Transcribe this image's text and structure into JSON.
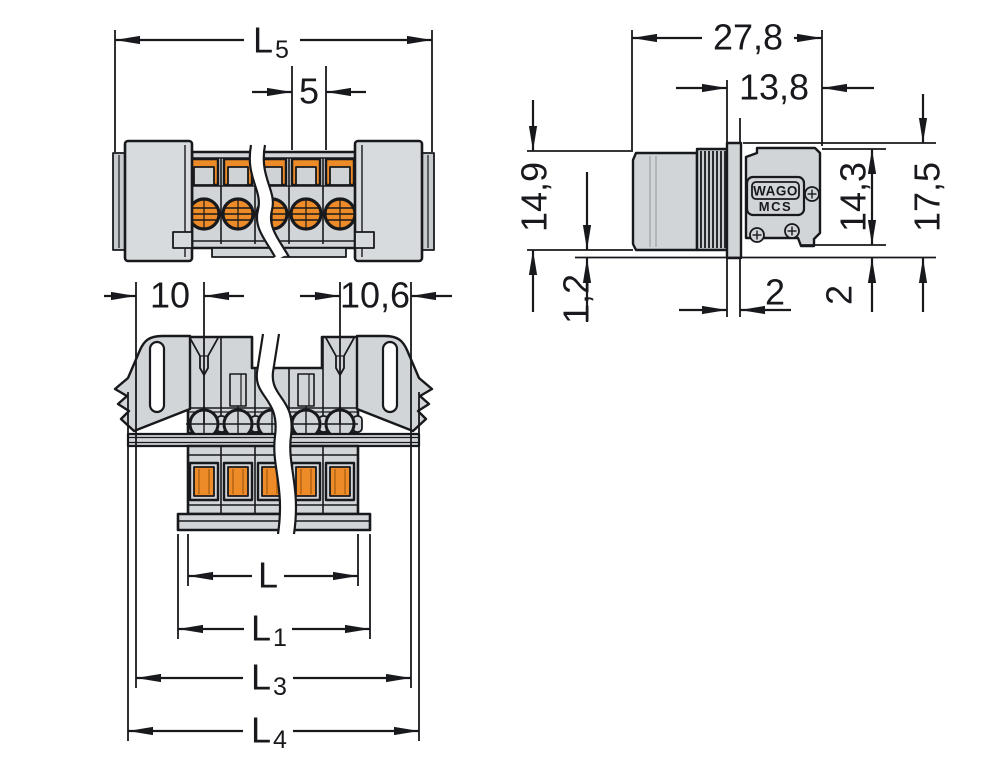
{
  "meta": {
    "description": "Dimensional line drawing of a WAGO MCS plug connector with panel mounting flanges"
  },
  "colors": {
    "line": "#17191c",
    "body": "#d2d5d7",
    "body_light": "#d8dbdd",
    "body_dark": "#c6cacc",
    "accent_orange": "#ed8b28",
    "background": "#ffffff"
  },
  "branding": {
    "logo": "WAGO",
    "series": "MCS"
  },
  "views": {
    "front": {
      "l5_base": "L",
      "l5_sub": "5",
      "pitch": "5"
    },
    "plug": {
      "d10": "10",
      "d106": "10,6",
      "l_base": "L",
      "l1_base": "L",
      "l1_sub": "1",
      "l3_base": "L",
      "l3_sub": "3",
      "l4_base": "L",
      "l4_sub": "4"
    },
    "side": {
      "d278": "27,8",
      "d138": "13,8",
      "d149": "14,9",
      "d12": "1,2",
      "d143": "14,3",
      "d175": "17,5",
      "d2_panel": "2",
      "d2_edge": "2"
    }
  }
}
